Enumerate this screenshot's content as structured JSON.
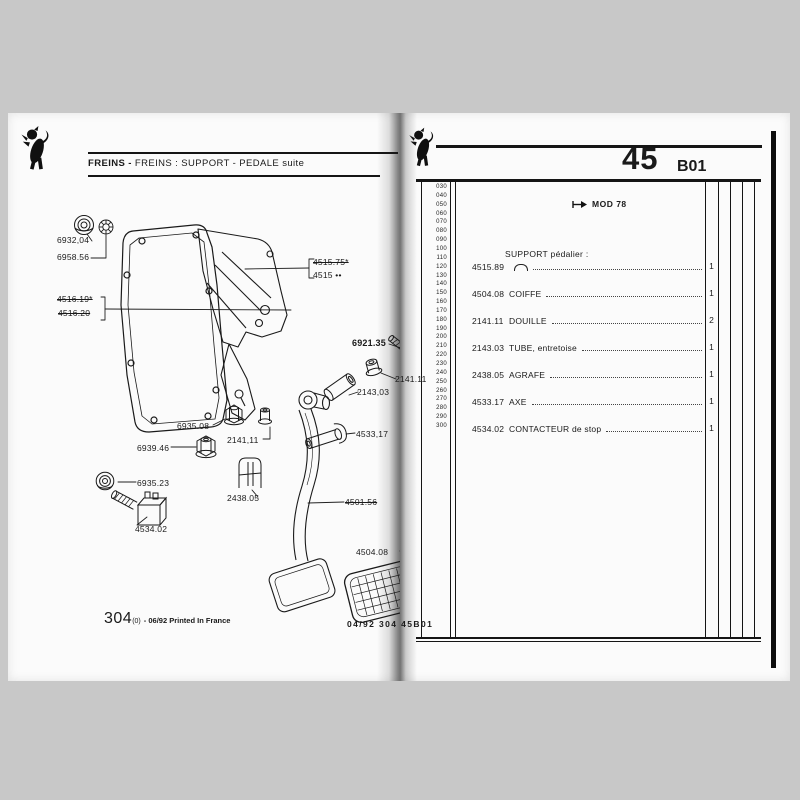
{
  "background": "#c8c8c8",
  "ink": "#1a1a1a",
  "left_page": {
    "header": {
      "bold": "FREINS - ",
      "rest": "FREINS : SUPPORT - PEDALE suite"
    },
    "footer": {
      "big": "304",
      "sub": "(0)",
      "rest": "- 06/92 Printed In France"
    },
    "plate_code": "04/92  304  45B01",
    "part_labels": [
      {
        "text": "6932,04",
        "x": 49,
        "y": 122,
        "strike": false,
        "bold": false
      },
      {
        "text": "6958.56",
        "x": 49,
        "y": 139,
        "strike": false,
        "bold": false
      },
      {
        "text": "4516.19*",
        "x": 49,
        "y": 181,
        "strike": true,
        "bold": false
      },
      {
        "text": "4516.20",
        "x": 50,
        "y": 195,
        "strike": true,
        "bold": false
      },
      {
        "text": "4515.75*",
        "x": 305,
        "y": 144,
        "strike": true,
        "bold": false
      },
      {
        "text": "4515 ••",
        "x": 305,
        "y": 157,
        "strike": false,
        "bold": false
      },
      {
        "text": "6921.35",
        "x": 344,
        "y": 225,
        "strike": false,
        "bold": true
      },
      {
        "text": "2141.11",
        "x": 387,
        "y": 261,
        "strike": false,
        "bold": false
      },
      {
        "text": "2143,03",
        "x": 349,
        "y": 274,
        "strike": false,
        "bold": false
      },
      {
        "text": "6935.08",
        "x": 169,
        "y": 308,
        "strike": false,
        "bold": false
      },
      {
        "text": "2141,11",
        "x": 219,
        "y": 322,
        "strike": false,
        "bold": false
      },
      {
        "text": "6939.46",
        "x": 129,
        "y": 330,
        "strike": false,
        "bold": false
      },
      {
        "text": "6935.23",
        "x": 129,
        "y": 365,
        "strike": false,
        "bold": false
      },
      {
        "text": "2438.05",
        "x": 219,
        "y": 380,
        "strike": false,
        "bold": false
      },
      {
        "text": "4534.02",
        "x": 127,
        "y": 411,
        "strike": false,
        "bold": false
      },
      {
        "text": "4533,17",
        "x": 348,
        "y": 316,
        "strike": false,
        "bold": false
      },
      {
        "text": "4501.56",
        "x": 337,
        "y": 384,
        "strike": true,
        "bold": false
      },
      {
        "text": "4504.08",
        "x": 348,
        "y": 434,
        "strike": false,
        "bold": false
      }
    ]
  },
  "right_page": {
    "section_number": "45",
    "section_code": "B01",
    "mod_note": "MOD 78",
    "margin_numbers": [
      "030",
      "040",
      "050",
      "060",
      "070",
      "080",
      "090",
      "100",
      "110",
      "120",
      "130",
      "140",
      "150",
      "160",
      "170",
      "180",
      "190",
      "200",
      "210",
      "220",
      "230",
      "240",
      "250",
      "260",
      "270",
      "280",
      "290",
      "300"
    ],
    "group_header": "SUPPORT pédalier :",
    "rows": [
      {
        "ref": "4515.89",
        "symbol": "arc",
        "desc": "",
        "qty": "1"
      },
      {
        "ref": "4504.08",
        "symbol": "",
        "desc": "COIFFE",
        "qty": "1"
      },
      {
        "ref": "2141.11",
        "symbol": "",
        "desc": "DOUILLE",
        "qty": "2"
      },
      {
        "ref": "2143.03",
        "symbol": "",
        "desc": "TUBE, entretoise",
        "qty": "1"
      },
      {
        "ref": "2438.05",
        "symbol": "",
        "desc": "AGRAFE",
        "qty": "1"
      },
      {
        "ref": "4533.17",
        "symbol": "",
        "desc": "AXE",
        "qty": "1"
      },
      {
        "ref": "4534.02",
        "symbol": "",
        "desc": "CONTACTEUR de stop",
        "qty": "1"
      }
    ]
  }
}
